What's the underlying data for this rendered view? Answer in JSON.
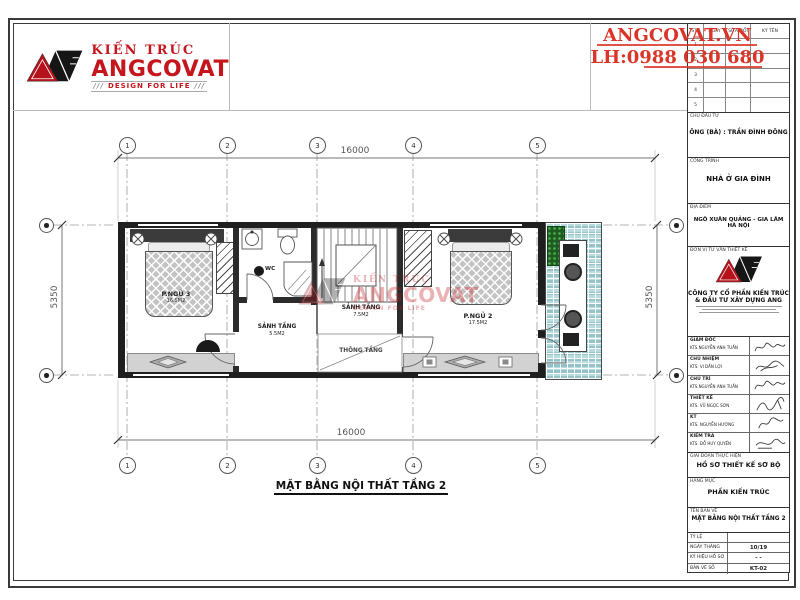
{
  "brand": {
    "kien_truc": "KIẾN TRÚC",
    "name": "ANGCOVAT",
    "tagline": "DESIGN FOR LIFE",
    "website": "ANGCOVAT.VN",
    "hotline": "LH:0988 030 680",
    "accent_red": "#c4161c"
  },
  "plan": {
    "title": "MẶT BẰNG NỘI THẤT TẦNG 2",
    "dim_top": "16000",
    "dim_bottom": "16000",
    "dim_left": "5350",
    "dim_right": "5350",
    "grid_top": [
      "1",
      "2",
      "3",
      "4",
      "5"
    ],
    "grid_bottom": [
      "1",
      "2",
      "3",
      "4",
      "5"
    ],
    "rooms": {
      "bedroom3": {
        "name": "P.NGỦ 3",
        "area": "16.5M2"
      },
      "bedroom2": {
        "name": "P.NGỦ 2",
        "area": "17.5M2"
      },
      "wc": {
        "name": "WC"
      },
      "hall": {
        "name": "SẢNH TẦNG",
        "area": "5.5M2"
      },
      "stair_hall": {
        "name": "SẢNH TẦNG",
        "area": "7.5M2"
      },
      "void": {
        "name": "THÔNG TẦNG"
      }
    }
  },
  "titleblock": {
    "revision": {
      "cols": [
        "STT",
        "NGÀY",
        "SỬA ĐỔI",
        "KÝ TÊN"
      ],
      "rows": [
        "1",
        "2",
        "3",
        "4",
        "5"
      ]
    },
    "owner_label": "CHỦ ĐẦU TƯ",
    "owner": "ÔNG (BÀ) : TRẦN ĐÌNH ĐÔNG",
    "project_label": "CÔNG TRÌNH",
    "project": "NHÀ Ở GIA ĐÌNH",
    "location_label": "ĐỊA ĐIỂM",
    "location1": "NGÔ XUÂN QUẢNG - GIA LÂM",
    "location2": "HÀ NỘI",
    "consultant_label": "ĐƠN VỊ TƯ VẤN THIẾT KẾ",
    "company1": "CÔNG TY CỔ PHẦN KIẾN TRÚC",
    "company2": "& ĐẦU TƯ XÂY DỰNG ANG",
    "signatures": [
      {
        "role": "GIÁM ĐỐC",
        "name": "KTS.NGUYỄN ANH TUẤN"
      },
      {
        "role": "CHỦ NHIỆM",
        "name": "KTS. VI DẦN LỢI"
      },
      {
        "role": "CHỦ TRÌ",
        "name": "KTS.NGUYỄN ANH TUẤN"
      },
      {
        "role": "THIẾT KẾ",
        "name": "KTS. VŨ NGỌC SƠN"
      },
      {
        "role": "KT",
        "name": "KTS. NGUYỄN HƯƠNG"
      },
      {
        "role": "KIỂM TRA",
        "name": "KTS. ĐỖ HUY QUYỀN"
      }
    ],
    "stage_label": "GIAI ĐOẠN THỰC HIỆN",
    "stage": "HỒ SƠ THIẾT KẾ SƠ BỘ",
    "category_label": "HẠNG MỤC",
    "category": "PHẦN KIẾN TRÚC",
    "drawing_label": "TÊN BẢN VẼ",
    "drawing": "MẶT BẰNG NỘI THẤT TẦNG 2",
    "meta": [
      {
        "label": "TỶ LỆ",
        "value": ""
      },
      {
        "label": "NGÀY THÁNG",
        "value": "10/19"
      },
      {
        "label": "KÝ HIỆU HỒ SƠ",
        "value": "- -"
      },
      {
        "label": "BẢN VẼ SỐ",
        "value": "KT-02"
      }
    ]
  }
}
